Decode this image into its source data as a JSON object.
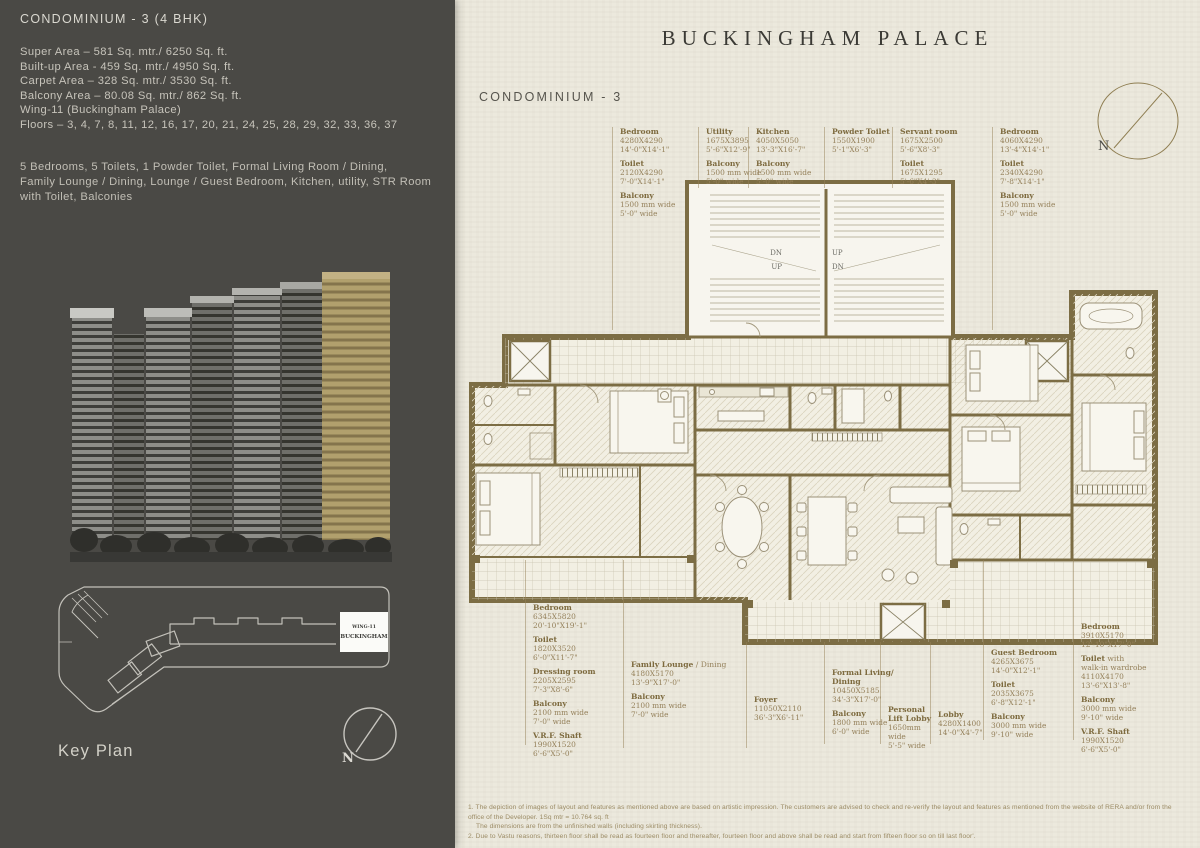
{
  "left_panel": {
    "title": "CONDOMINIUM - 3 (4 BHK)",
    "specs": [
      "Super Area – 581 Sq. mtr./  6250 Sq. ft.",
      "Built-up Area - 459 Sq. mtr./ 4950 Sq. ft.",
      "Carpet Area –  328 Sq. mtr./ 3530 Sq. ft.",
      "Balcony Area – 80.08 Sq. mtr./ 862 Sq. ft.",
      "Wing-11 (Buckingham Palace)",
      "Floors – 3, 4, 7, 8, 11, 12, 16, 17, 20, 21, 24, 25, 28, 29, 32, 33, 36, 37"
    ],
    "description": [
      "5 Bedrooms, 5 Toilets, 1 Powder Toilet, Formal Living Room / Dining,",
      "Family Lounge / Dining,  Lounge / Guest Bedroom, Kitchen, utility, STR Room with Toilet, Balconies"
    ],
    "key_plan": {
      "label": "Key Plan",
      "wing_line1": "WING-11",
      "wing_line2": "BUCKINGHAM",
      "compass": "N"
    }
  },
  "plan_sheet": {
    "title": "BUCKINGHAM PALACE",
    "subtitle": "CONDOMINIUM - 3",
    "compass": "N",
    "stairs": {
      "dn_left": "DN",
      "up_left": "UP",
      "up_right": "UP",
      "dn_right": "DN"
    },
    "labels": {
      "top": [
        {
          "groups": [
            {
              "title": "Bedroom",
              "lines": [
                "4280X4290",
                "14'-0\"X14'-1\""
              ]
            },
            {
              "title": "Toilet",
              "lines": [
                "2120X4290",
                "7'-0\"X14'-1\""
              ]
            },
            {
              "title": "Balcony",
              "lines": [
                "1500 mm wide",
                "5'-0\" wide"
              ]
            }
          ]
        },
        {
          "groups": [
            {
              "title": "Utility",
              "lines": [
                "1675X3895",
                "5'-6\"X12'-9\""
              ]
            },
            {
              "title": "Balcony",
              "lines": [
                "1500 mm wide",
                "5'-0\" wide"
              ]
            }
          ]
        },
        {
          "groups": [
            {
              "title": "Kitchen",
              "lines": [
                "4050X5050",
                "13'-3\"X16'-7\""
              ]
            },
            {
              "title": "Balcony",
              "lines": [
                "1500 mm wide",
                "5'-0\" wide"
              ]
            }
          ]
        },
        {
          "groups": [
            {
              "title": "Powder Toilet",
              "lines": [
                "1550X1900",
                "5'-1\"X6'-3\""
              ]
            }
          ]
        },
        {
          "groups": [
            {
              "title": "Servant room",
              "lines": [
                "1675X2500",
                "5'-6\"X8'-3\""
              ]
            },
            {
              "title": "Toilet",
              "lines": [
                "1675X1295",
                "5'-6\"X4'-3\""
              ]
            }
          ]
        },
        {
          "groups": [
            {
              "title": "Bedroom",
              "lines": [
                "4060X4290",
                "13'-4\"X14'-1\""
              ]
            },
            {
              "title": "Toilet",
              "lines": [
                "2340X4290",
                "7'-8\"X14'-1\""
              ]
            },
            {
              "title": "Balcony",
              "lines": [
                "1500 mm wide",
                "5'-0\" wide"
              ]
            }
          ]
        }
      ],
      "bottom": [
        {
          "groups": [
            {
              "title": "Bedroom",
              "lines": [
                "6345X5820",
                "20'-10\"X19'-1\""
              ]
            },
            {
              "title": "Toilet",
              "lines": [
                "1820X3520",
                "6'-0\"X11'-7\""
              ]
            },
            {
              "title": "Dressing room",
              "lines": [
                "2205X2595",
                "7'-3\"X8'-6\""
              ]
            },
            {
              "title": "Balcony",
              "lines": [
                "2100 mm wide",
                "7'-0\" wide"
              ]
            },
            {
              "title": "V.R.F. Shaft",
              "lines": [
                "1990X1520",
                "6'-6\"X5'-0\""
              ]
            }
          ]
        },
        {
          "groups": [
            {
              "title": "Family Lounge",
              "suffix": " / Dining",
              "lines": [
                "4180X5170",
                "13'-9\"X17'-0\""
              ]
            },
            {
              "title": "Balcony",
              "lines": [
                "2100 mm wide",
                "7'-0\" wide"
              ]
            }
          ]
        },
        {
          "groups": [
            {
              "title": "Foyer",
              "lines": [
                "11050X2110",
                "36'-3\"X6'-11\""
              ]
            }
          ]
        },
        {
          "groups": [
            {
              "title": "Formal Living/ Dining",
              "lines": [
                "10450X5185",
                "34'-3\"X17'-0\""
              ]
            },
            {
              "title": "Balcony",
              "lines": [
                "1800 mm wide",
                "6'-0\" wide"
              ]
            }
          ]
        },
        {
          "groups": [
            {
              "title": "Personal Lift Lobby",
              "lines": [
                "1650mm wide",
                "5'-5\" wide"
              ]
            }
          ]
        },
        {
          "groups": [
            {
              "title": "Lobby",
              "lines": [
                "4280X1400",
                "14'-0\"X4'-7\""
              ]
            }
          ]
        },
        {
          "groups": [
            {
              "title": "Guest Bedroom",
              "lines": [
                "4265X3675",
                "14'-0\"X12'-1\""
              ]
            },
            {
              "title": "Toilet",
              "lines": [
                "2035X3675",
                "6'-8\"X12'-1\""
              ]
            },
            {
              "title": "Balcony",
              "lines": [
                "3000 mm wide",
                "9'-10\" wide"
              ]
            }
          ]
        },
        {
          "groups": [
            {
              "title": "Bedroom",
              "lines": [
                "3910X5170",
                "12'-10\"X17'-0\""
              ]
            },
            {
              "title": "Toilet",
              "suffix": " with",
              "lines": [
                "walk-in wardrobe",
                "4110X4170",
                "13'-6\"X13'-8\""
              ]
            },
            {
              "title": "Balcony",
              "lines": [
                "3000 mm wide",
                "9'-10\" wide"
              ]
            },
            {
              "title": "V.R.F. Shaft",
              "lines": [
                "1990X1520",
                "6'-6\"X5'-0\""
              ]
            }
          ]
        }
      ]
    },
    "footnotes": [
      "1. The depiction of images of layout and features as mentioned above are based on artistic impression. The customers are advised to check and re-verify the layout and features as mentioned from the website of RERA and/or from the office of the Developer. 1Sq mtr = 10.764 sq. ft",
      "The dimensions are from the unfinished walls (including skirting thickness).",
      "2. Due to Vastu reasons, thirteen floor shall be read as fourteen floor and thereafter, fourteen floor and above shall be read and start from fifteen floor so on till last floor'."
    ]
  }
}
